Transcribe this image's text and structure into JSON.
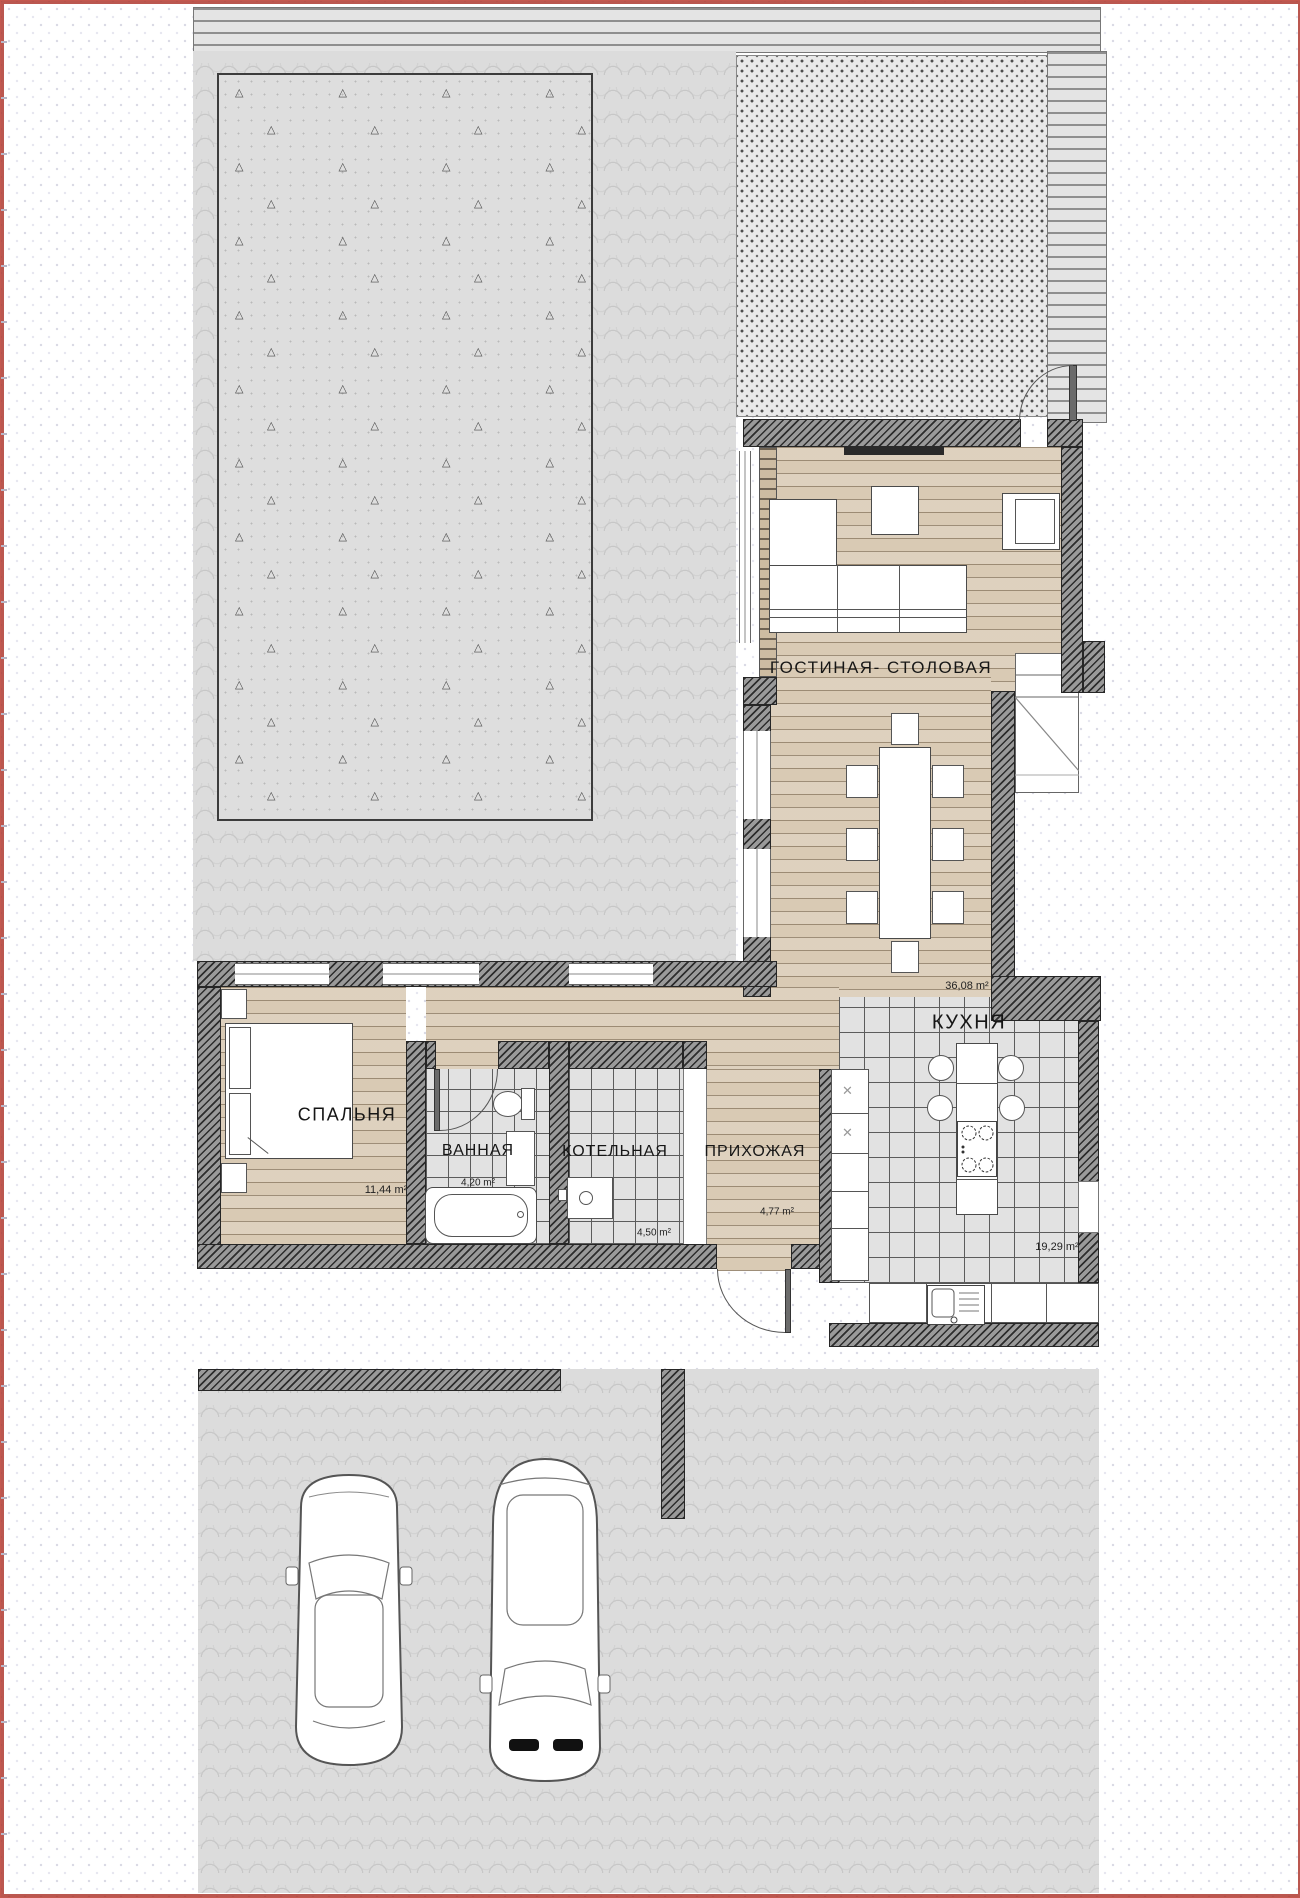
{
  "rooms": [
    {
      "name": "ГОСТИНАЯ- СТОЛОВАЯ",
      "area": "36,08 m²"
    },
    {
      "name": "КУХНЯ",
      "area": "19,29 m²"
    },
    {
      "name": "СПАЛЬНЯ",
      "area": "11,44 m²"
    },
    {
      "name": "ВАННАЯ",
      "area": "4,20 m²"
    },
    {
      "name": "КОТЕЛЬНАЯ",
      "area": "4,50 m²"
    },
    {
      "name": "ПРИХОЖАЯ",
      "area": "4,77 m²"
    }
  ],
  "palette": {
    "wall_hatch": "#9a9a9a",
    "wood_floor": "#d9cab4",
    "tile_floor": "#e2e2e2",
    "paving": "#dcdcdc",
    "lawn": "#dedede",
    "deck": "#e4e4e4",
    "sheet_border_red": "#b23a30",
    "label_text": "#161616"
  }
}
